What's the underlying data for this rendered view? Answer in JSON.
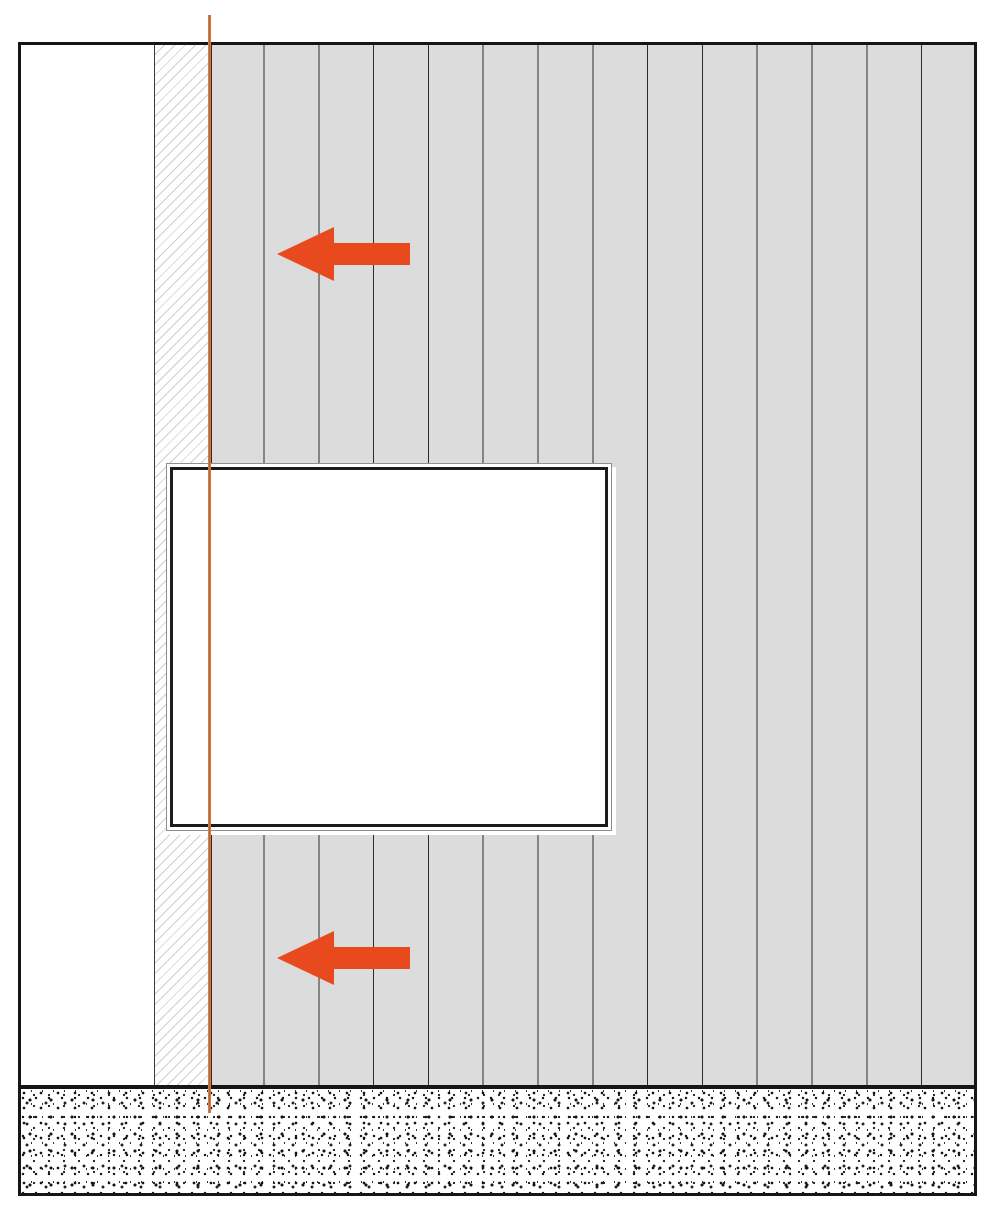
{
  "diagram": {
    "kind": "facade-cladding-installation-elevation",
    "text_labels": [],
    "wall": {
      "outline": "rectangular wall elevation with heavy black outline",
      "interior_strip": "plain white strip at left edge",
      "substrate_strip": "narrow strip with light diagonal hatching",
      "cladding": {
        "orientation": "vertical",
        "panel_count": 14,
        "joint_lines": 13
      }
    },
    "window": {
      "shape": "rectangular opening",
      "frame": "double frame: thin outer line and heavy inner line",
      "fill": "white"
    },
    "reference_line": {
      "orientation": "vertical",
      "position": "at junction of hatched strip and first cladding panel",
      "extends": "above wall outline at top and into ground band at bottom"
    },
    "arrows": [
      {
        "direction": "left",
        "location": "upper cladding field"
      },
      {
        "direction": "left",
        "location": "lower cladding field"
      }
    ],
    "ground_band": {
      "texture": "dense black speckle on white (concrete/ground)",
      "borders": "heavy black line top and bottom"
    }
  },
  "colors": {
    "background": "#ffffff",
    "line_dark": "#161616",
    "panel_fill": "#dcdcdc",
    "hatch_gray": "#cfcfcf",
    "arrow_orange": "#e8491d",
    "reference_line_orange": "#c0612f"
  }
}
